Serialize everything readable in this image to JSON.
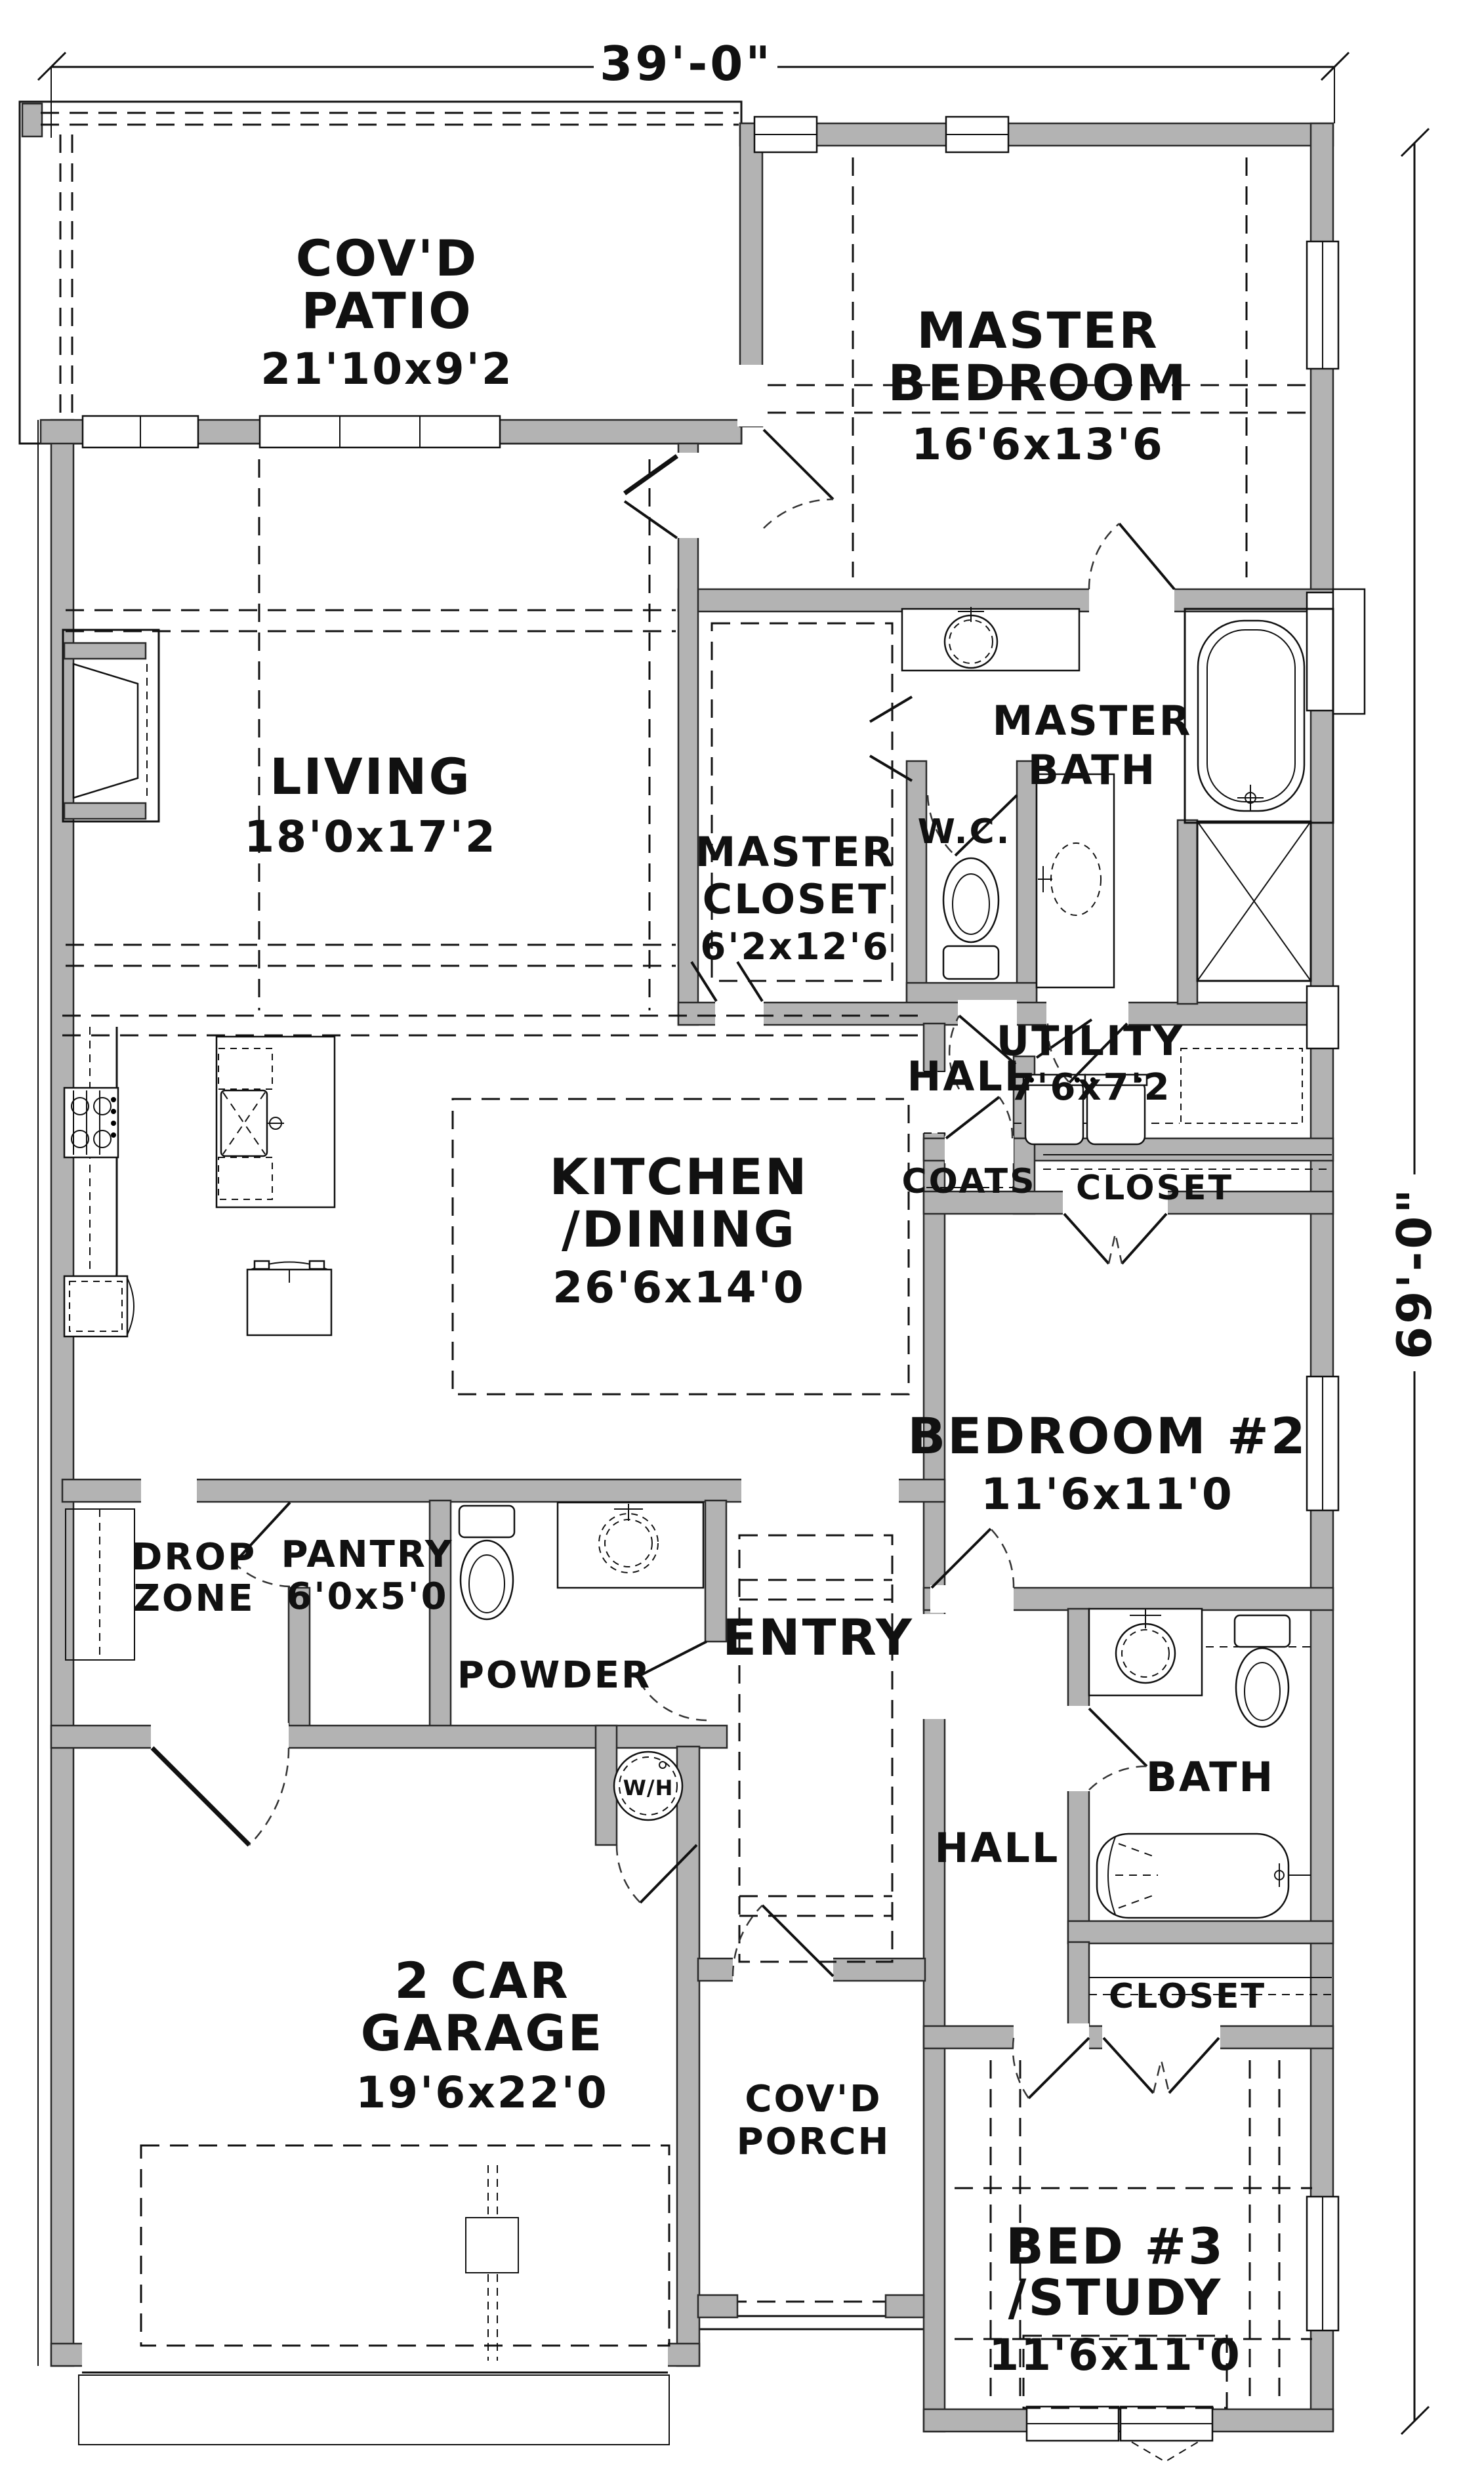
{
  "dimensions": {
    "top": "39'-0\"",
    "right": "69'-0\""
  },
  "rooms": {
    "covd_patio": {
      "l1": "COV'D",
      "l2": "PATIO",
      "dims": "21'10x9'2"
    },
    "master_bedroom": {
      "l1": "MASTER",
      "l2": "BEDROOM",
      "dims": "16'6x13'6"
    },
    "living": {
      "l1": "LIVING",
      "dims": "18'0x17'2"
    },
    "master_bath": {
      "l1": "MASTER",
      "l2": "BATH"
    },
    "master_closet": {
      "l1": "MASTER",
      "l2": "CLOSET",
      "dims": "6'2x12'6"
    },
    "wc": {
      "l1": "W.C."
    },
    "hall_master": {
      "l1": "HALL"
    },
    "utility": {
      "l1": "UTILITY",
      "dims": "7'6x7'2"
    },
    "coats": {
      "l1": "COATS"
    },
    "closet_hall": {
      "l1": "CLOSET"
    },
    "kitchen_dining": {
      "l1": "KITCHEN",
      "l2": "/DINING",
      "dims": "26'6x14'0"
    },
    "bedroom2": {
      "l1": "BEDROOM #2",
      "dims": "11'6x11'0"
    },
    "drop_zone": {
      "l1": "DROP",
      "l2": "ZONE"
    },
    "pantry": {
      "l1": "PANTRY",
      "dims": "6'0x5'0"
    },
    "powder": {
      "l1": "POWDER"
    },
    "entry": {
      "l1": "ENTRY"
    },
    "hall_bed": {
      "l1": "HALL"
    },
    "bath2": {
      "l1": "BATH"
    },
    "closet_bath": {
      "l1": "CLOSET"
    },
    "garage": {
      "l1": "2 CAR",
      "l2": "GARAGE",
      "dims": "19'6x22'0"
    },
    "covd_porch": {
      "l1": "COV'D",
      "l2": "PORCH"
    },
    "bed3_study": {
      "l1": "BED #3",
      "l2": "/STUDY",
      "dims": "11'6x11'0"
    },
    "water_heater": {
      "l1": "W/H"
    }
  }
}
